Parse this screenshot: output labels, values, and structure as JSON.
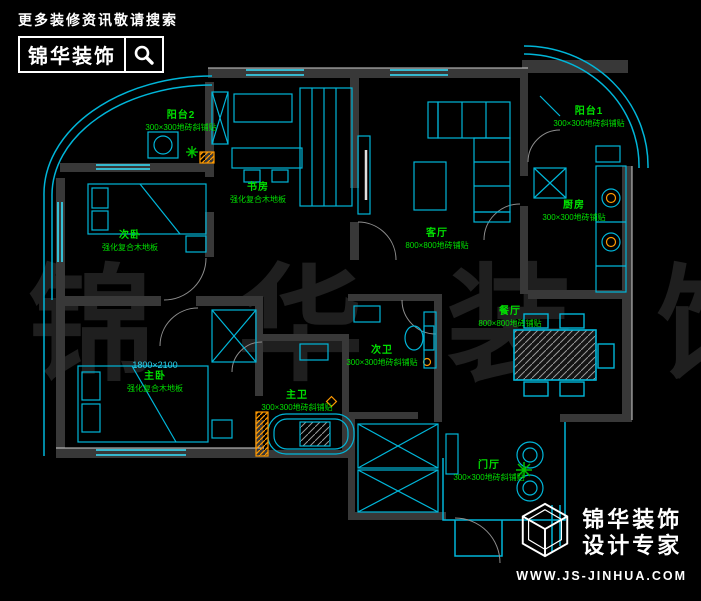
{
  "header": {
    "tagline": "更多装修资讯敬请搜索",
    "brand": "锦华装饰"
  },
  "footer": {
    "brand_line1": "锦华装饰",
    "brand_line2": "设计专家",
    "website": "WWW.JS-JINHUA.COM"
  },
  "watermark": "锦 华 装 饰",
  "colors": {
    "line_cyan": "#00b6d9",
    "line_bright": "#35e3ff",
    "wall_gray": "#383838",
    "label_green": "#00e000",
    "accent_orange": "#ff9900"
  },
  "rooms": [
    {
      "id": "yangtai2",
      "name": "阳台2",
      "note": "300×300地砖斜铺贴"
    },
    {
      "id": "shufang",
      "name": "书房",
      "note": "强化复合木地板"
    },
    {
      "id": "keting",
      "name": "客厅",
      "note": "800×800地砖铺贴"
    },
    {
      "id": "yangtai1",
      "name": "阳台1",
      "note": "300×300地砖斜铺贴"
    },
    {
      "id": "chufang",
      "name": "厨房",
      "note": "300×300地砖铺贴"
    },
    {
      "id": "ciwo",
      "name": "次卧",
      "note": "强化复合木地板"
    },
    {
      "id": "zhuwo",
      "name": "主卧",
      "note": "强化复合木地板",
      "size": "1800×2100"
    },
    {
      "id": "ciwei",
      "name": "次卫",
      "note": "300×300地砖斜铺贴"
    },
    {
      "id": "zhuwei",
      "name": "主卫",
      "note": "300×300地砖斜铺贴"
    },
    {
      "id": "canting",
      "name": "餐厅",
      "note": "800×800地砖铺贴"
    },
    {
      "id": "menting",
      "name": "门厅",
      "note": "300×300地砖斜铺贴"
    }
  ]
}
